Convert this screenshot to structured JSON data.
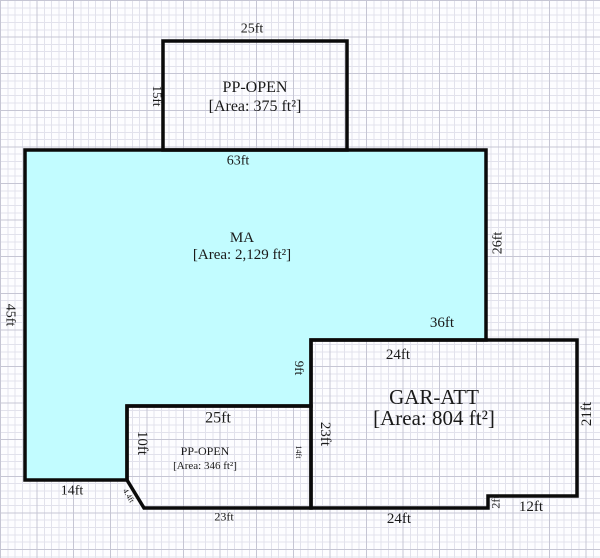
{
  "sketch_title": "Floor plan sketch",
  "rooms": {
    "pp_open_top": {
      "name": "PP-OPEN",
      "area": "[Area: 375 ft²]"
    },
    "ma": {
      "name": "MA",
      "area": "[Area: 2,129 ft²]"
    },
    "gar_att": {
      "name": "GAR-ATT",
      "area": "[Area: 804 ft²]"
    },
    "pp_open_bottom": {
      "name": "PP-OPEN",
      "area": "[Area: 346 ft²]"
    }
  },
  "dims": {
    "pp_top_width": "25ft",
    "pp_top_left": "15ft",
    "ma_top": "63ft",
    "ma_right": "26ft",
    "ma_left": "45ft",
    "gar_top": "36ft",
    "ma_bottom_right": "24ft",
    "ma_step": "9ft",
    "gar_left": "23ft",
    "gar_right": "21ft",
    "ppb_top": "25ft",
    "ppb_left": "10ft",
    "ppb_right": "14ft",
    "ppb_diag": "4.4ft",
    "ma_bottom_left": "14ft",
    "ppb_bottom": "23ft",
    "gar_bottom": "24ft",
    "gar_step": "2ft",
    "gar_bottom_right": "12ft"
  },
  "colors": {
    "ma_fill": "#c2fcff",
    "wall": "#0a0a0a",
    "grid_minor": "#e2e2ec",
    "grid_major": "#c6c6d4",
    "paper": "#fdfdff"
  }
}
